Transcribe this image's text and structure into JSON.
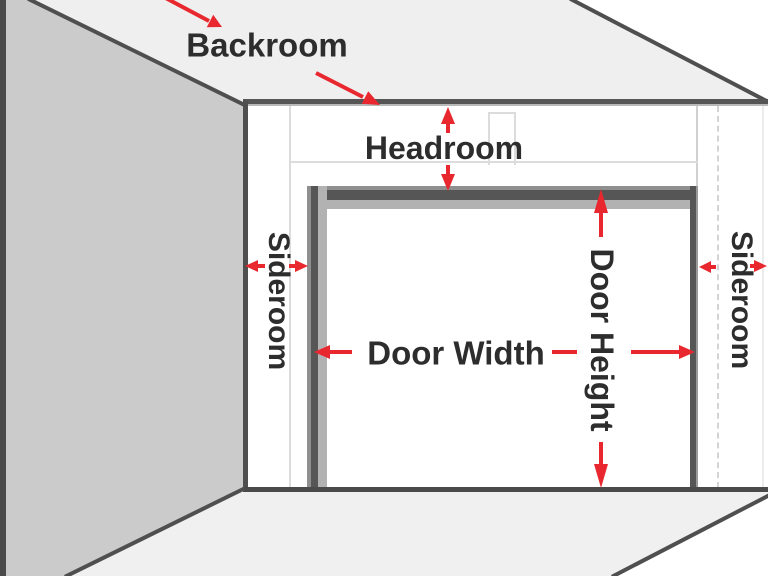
{
  "labels": {
    "backroom": "Backroom",
    "headroom": "Headroom",
    "sideroom_left": "Sideroom",
    "sideroom_right": "Sideroom",
    "door_width": "Door Width",
    "door_height": "Door Height"
  },
  "colors": {
    "arrow_red": "#e8282e",
    "text": "#2d2d2d",
    "left_wall": "#cbcbcb",
    "ceiling": "#efefef",
    "floor": "#f0f0f0",
    "back_wall": "#ffffff",
    "structure_line": "#4f4f4f",
    "frame_dark": "#565656",
    "frame_bevel": "#b2b2b2",
    "framing_line": "#dcdcdc"
  }
}
